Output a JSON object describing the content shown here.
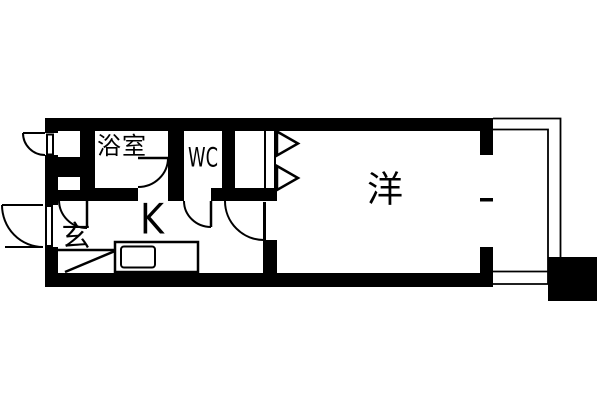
{
  "plan": {
    "background_color": "#ffffff",
    "ink_color": "#000000",
    "rooms": {
      "bathroom": "浴室",
      "toilet": "WC",
      "entrance": "玄",
      "kitchen": "K",
      "western_room": "洋"
    }
  }
}
